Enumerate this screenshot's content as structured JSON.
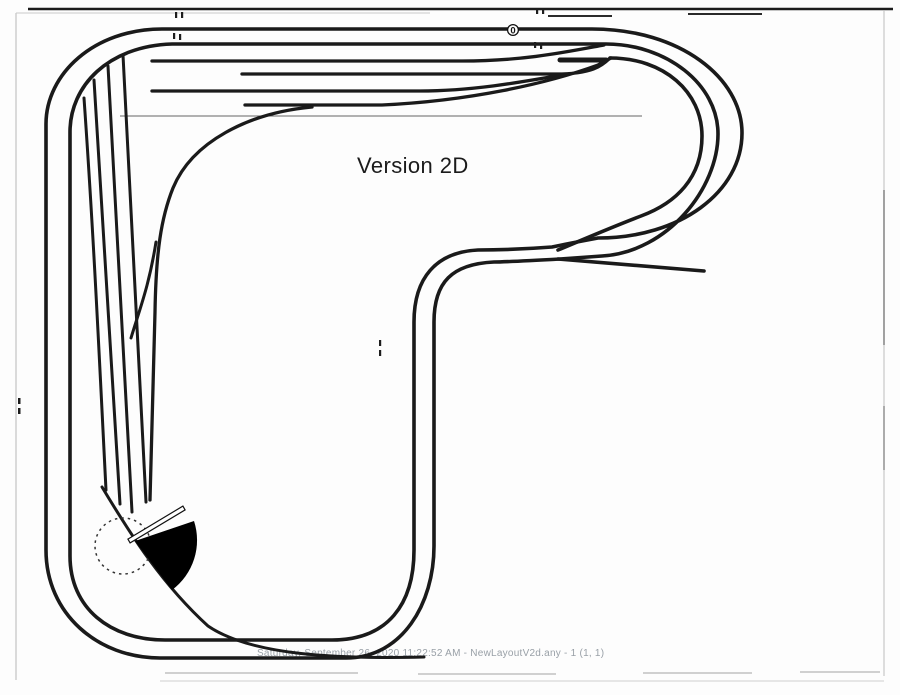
{
  "page": {
    "title": "Version 2D",
    "footer": "Saturday, September 26, 2020 11:22:52 AM - NewLayoutV2d.any - 1 (1, 1)"
  },
  "markers": {
    "origin_label": "0"
  },
  "colors": {
    "track": "#1a1a1a",
    "paper": "#fdfdfd",
    "scan_border": "#b8b8b8",
    "footer_text": "#99a0a7",
    "turntable_fill": "#000000"
  }
}
